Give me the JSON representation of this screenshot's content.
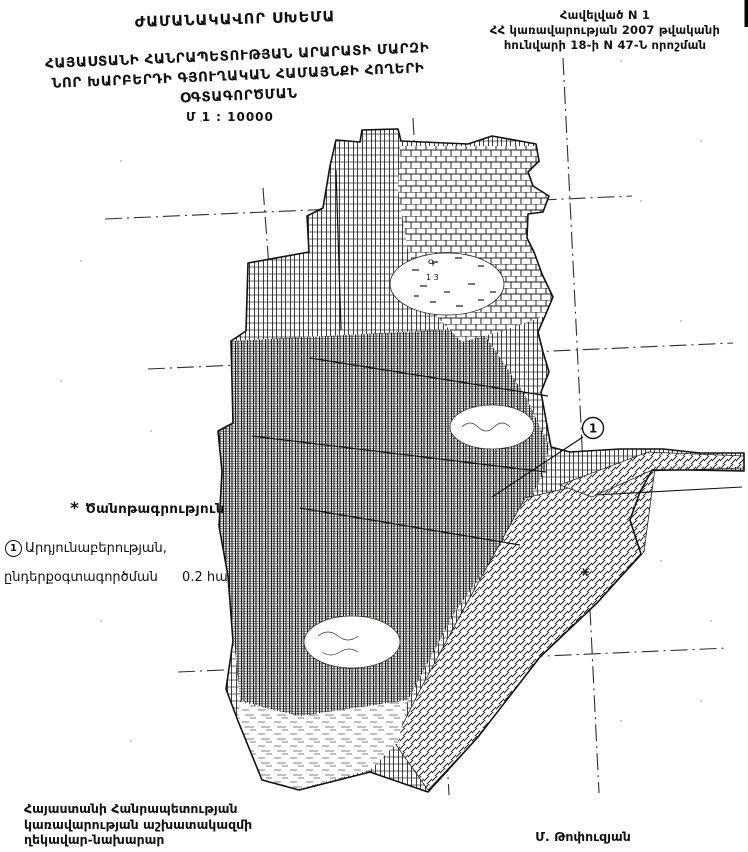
{
  "page": {
    "header_right": {
      "line1": "Հավելված N 1",
      "line2": "ՀՀ կառավարության 2007 թվականի",
      "line3": "հունվարի 18-ի N 47-Ն որոշման"
    },
    "title": {
      "line1": "ԺԱՄԱՆԱԿԱՎՈՐ ՍԽԵՄԱ",
      "line2": "ՀԱՅԱՍՏԱՆԻ ՀԱՆՐԱՊԵՏՈՒԹՅԱՆ ԱՐԱՐԱՏԻ ՄԱՐԶԻ",
      "line3": "ՆՈՐ ԽԱՐԲԵՐԴԻ ԳՅՈՒՂԱԿԱՆ ՀԱՄԱՅՆՔԻ ՀՈՂԵՐԻ",
      "line4": "ՕԳՏԱԳՈՐԾՄԱՆ",
      "scale": "Մ 1 : 10000"
    },
    "note": {
      "marker": "*",
      "heading": "Ծանոթագրություն",
      "item_number": "1",
      "item_text": "Արդյունաբերության,",
      "item_text2": "ընդերքօգտագործման",
      "item_area": "0.2 հա"
    },
    "map": {
      "callout_number": "1",
      "marsh_label": "Գ",
      "marsh_label2": "1 3",
      "colors": {
        "ink": "#111111",
        "paper": "#ffffff"
      }
    },
    "footer": {
      "left_line1": "Հայաստանի Հանրապետության",
      "left_line2": "կառավարության աշխատակազմի",
      "left_line3": "ղեկավար-նախարար",
      "signature": "Մ. Թոփուզյան"
    }
  }
}
